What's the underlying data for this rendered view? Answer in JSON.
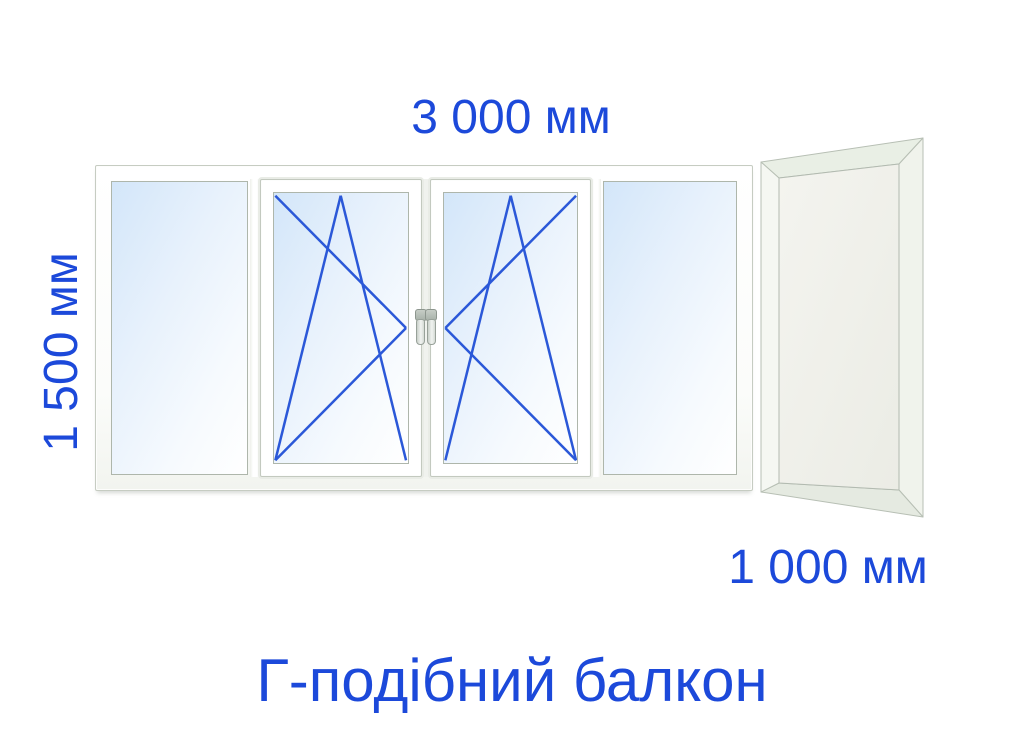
{
  "diagram": {
    "title": "Г-подібний балкон",
    "dimension_labels": {
      "front_width": "3 000 мм",
      "front_height": "1 500 мм",
      "side_width": "1 000 мм"
    },
    "front_window": {
      "panels": [
        {
          "position": 1,
          "type": "fixed"
        },
        {
          "position": 2,
          "type": "tilt-turn",
          "handle_side": "right"
        },
        {
          "position": 3,
          "type": "tilt-turn",
          "handle_side": "left"
        },
        {
          "position": 4,
          "type": "fixed"
        }
      ]
    },
    "side_window": {
      "view": "perspective-right",
      "panels": [
        {
          "position": 1,
          "type": "fixed"
        }
      ]
    },
    "colors": {
      "dimension_text": "#1c49da",
      "opening_symbol": "#2b58d8",
      "glass_tint_start": "#d3e6f9",
      "glass_tint_end": "#ffffff",
      "side_glass": "#f1f1ec",
      "frame_outline": "#c6ccc2"
    }
  }
}
